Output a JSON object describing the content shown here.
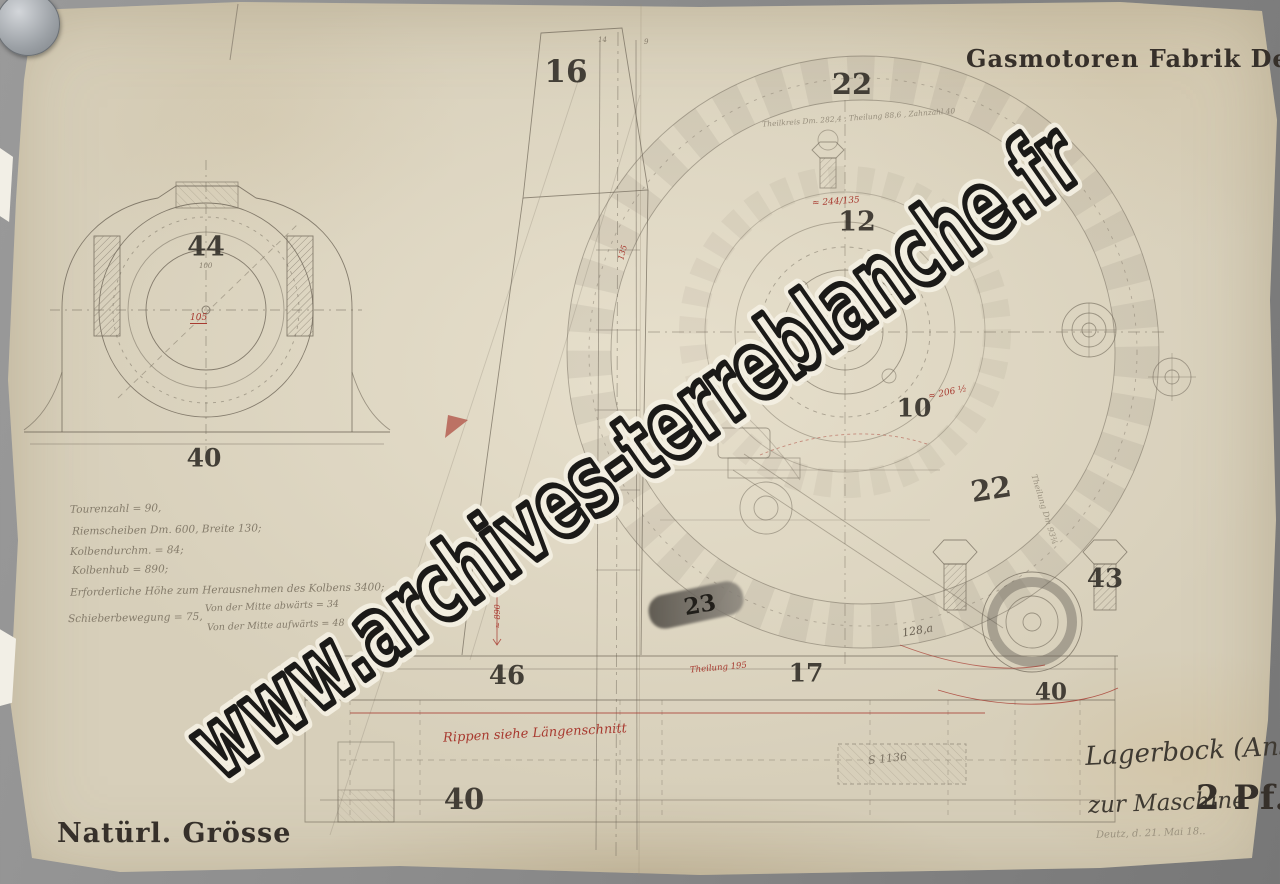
{
  "header": {
    "company": "Gasmotoren Fabrik Deutz"
  },
  "watermark": {
    "text": "www.archives-terreblanche.fr"
  },
  "footer": {
    "scale": "Natürl. Grösse",
    "part_name": "Lagerbock (Ansicht)",
    "machine_prefix": "zur Maschine",
    "machine_size": "2 Pf.",
    "date_line": "Deutz, d. 21. Mai 18.."
  },
  "notes": {
    "lines": [
      "Tourenzahl = 90,",
      "Riemscheiben Dm. 600, Breite 130;",
      "Kolbendurchm. = 84;",
      "Kolbenhub = 890;",
      "Erforderliche Höhe zum Herausnehmen des Kolbens 3400;",
      "Schieberbewegung = 75,",
      "Von der Mitte abwärts = 34",
      "Von der Mitte aufwärts = 48"
    ]
  },
  "part_labels": [
    {
      "text": "16"
    },
    {
      "text": "22"
    },
    {
      "text": "12"
    },
    {
      "text": "44"
    },
    {
      "text": "40"
    },
    {
      "text": "10"
    },
    {
      "text": "22"
    },
    {
      "text": "43"
    },
    {
      "text": "23"
    },
    {
      "text": "46"
    },
    {
      "text": "17"
    },
    {
      "text": "40"
    },
    {
      "text": "40"
    }
  ],
  "annotations": {
    "gear_arc": "Theilkreis Dm. 282,4 , Theilung 88,6 , Zahnzahl 40",
    "items": [
      {
        "text": "≈ 244/135"
      },
      {
        "text": "≈ 206 ½"
      },
      {
        "text": "Theilung 195"
      },
      {
        "text": "Theilung Dm 93¾"
      },
      {
        "text": "128,a"
      },
      {
        "text": "S 1136"
      },
      {
        "text": "Rippen siehe Längenschnitt"
      },
      {
        "text": "105"
      },
      {
        "text": "100"
      },
      {
        "text": "135"
      },
      {
        "text": "≈ 890"
      },
      {
        "text": "14"
      },
      {
        "text": "9"
      }
    ]
  },
  "colors": {
    "red_ink": "#a83a30",
    "line_ink": "#6e6557",
    "paper": "#d7cfba"
  }
}
